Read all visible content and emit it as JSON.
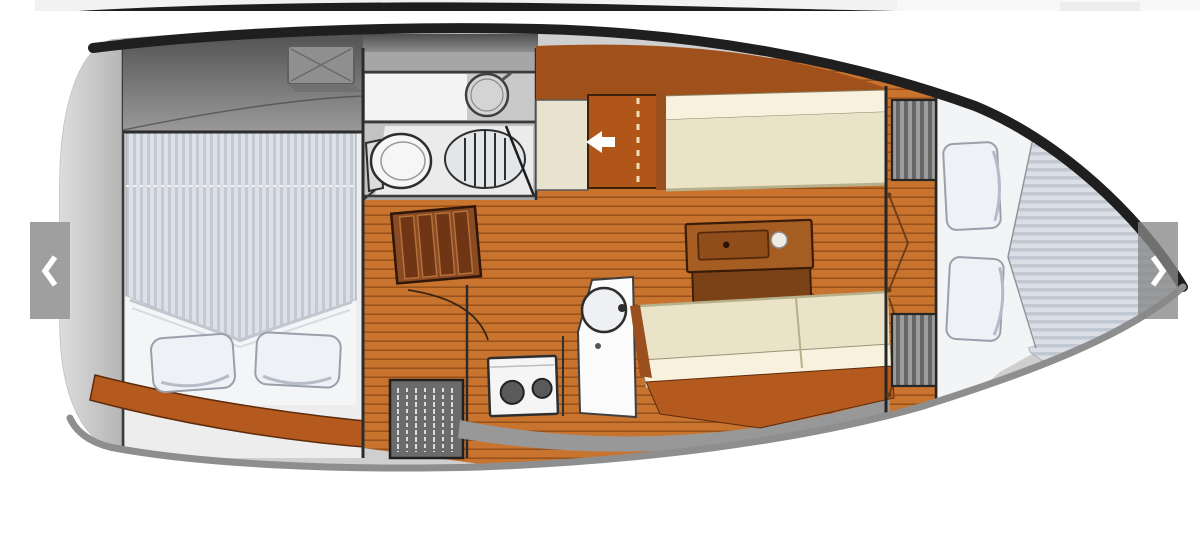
{
  "carousel": {
    "prev_icon": "chevron-left-icon",
    "next_icon": "chevron-right-icon",
    "prev_name": "previous",
    "next_name": "next"
  },
  "image": {
    "description": "Sailboat interior floor plan, top view, bow pointing right"
  },
  "colors": {
    "top_sliver": "#1e1e1e",
    "hull_outline": "#1f1f1f",
    "hull_bottom": "#8e8e8e",
    "deck_top": "#4f4f4f",
    "deck_bottom": "#9b9b9b",
    "stern_light": "#dedede",
    "interior_base": "#cfcfcf",
    "floor_wood": "#c9742e",
    "floor_seam": "#602606",
    "rust": "#a0501a",
    "wood_step": "#8a4a22",
    "settee_seat": "#ebe3c8",
    "settee_back": "#f7f1de",
    "trim_orange": "#b55a1e",
    "table_top": "#a55d22",
    "table_front": "#7c4217",
    "berth_base": "#dde1e7",
    "berth_stripe": "#c2c9d2",
    "bow_stripe_a": "#dbdfe5",
    "bow_stripe_b": "#c2c8d1",
    "pillow": "#eef1f5",
    "pillow_edge": "#9aa0ab",
    "fixture": "#f5f5f5",
    "line_dark": "#2e2e2e",
    "overlay_left": "#9f9f9f",
    "overlay_right": "rgba(136,136,136,0.78)",
    "chevron": "#ffffff"
  }
}
